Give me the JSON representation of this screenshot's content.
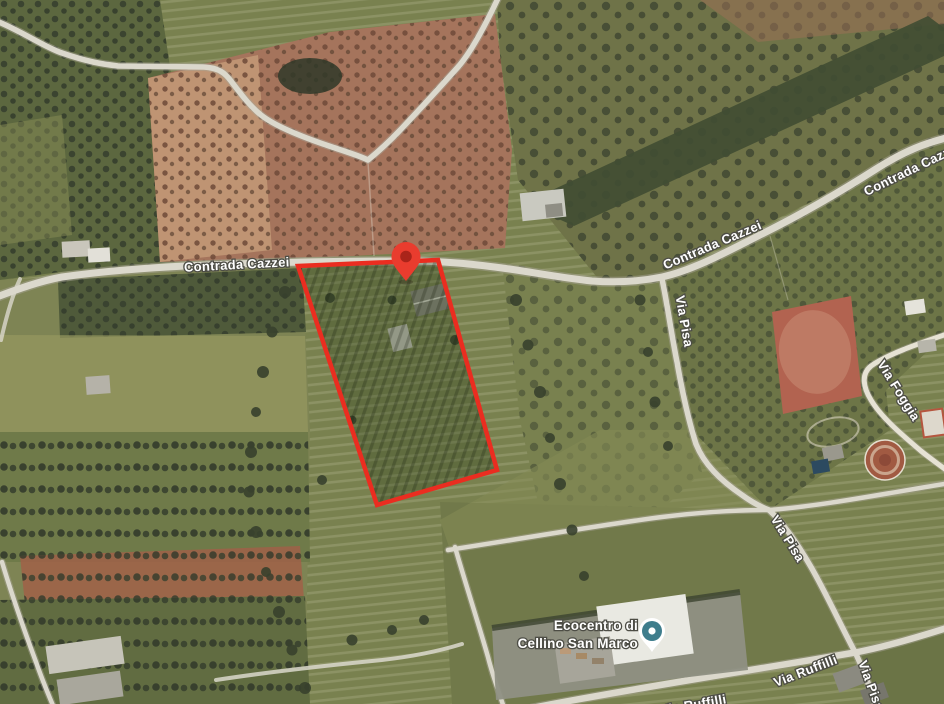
{
  "map": {
    "type": "satellite-imagery",
    "road_labels": [
      {
        "id": "contrada-cazzei-west",
        "text": "Contrada Cazzei"
      },
      {
        "id": "contrada-cazzei-east",
        "text": "Contrada Cazzei"
      },
      {
        "id": "contrada-cazzei-northeast",
        "text": "Contrada Cazzei"
      },
      {
        "id": "via-pisa-north",
        "text": "Via Pisa"
      },
      {
        "id": "via-foggia",
        "text": "Via Foggia"
      },
      {
        "id": "via-pisa-mid",
        "text": "Via Pisa"
      },
      {
        "id": "via-ruffilli",
        "text": "Via Ruffilli"
      },
      {
        "id": "via-pisa-south",
        "text": "Via Pisa"
      },
      {
        "id": "via-ruffilli-south",
        "text": "Via Ruffilli"
      }
    ],
    "place_label": {
      "line1": "Ecocentro di",
      "line2": "Cellino San Marco"
    },
    "markers": {
      "parcel_pin": "red location pin on Contrada Cazzei",
      "poi_pin": "Ecocentro di Cellino San Marco place pin"
    },
    "colors": {
      "parcel_outline": "#ea2d20",
      "pin_body": "#e93c2e",
      "pin_inner": "#aa241a",
      "poi_pin_body": "#ffffff",
      "poi_pin_circle": "#3e7d8c",
      "label_text": "#ffffff",
      "label_outline": "#4d4d45"
    }
  }
}
